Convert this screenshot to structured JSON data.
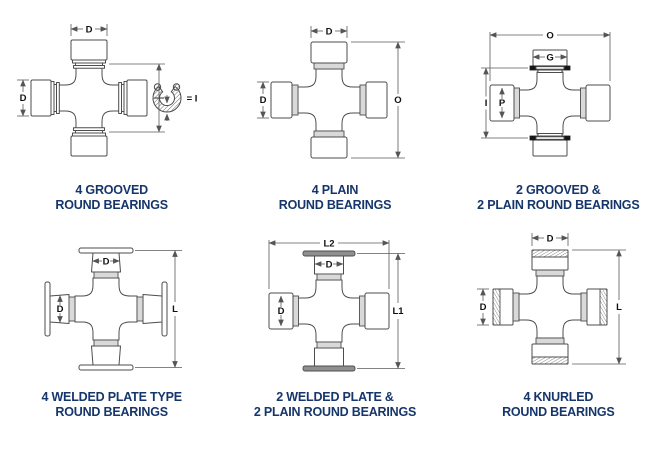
{
  "page": {
    "background": "#ffffff",
    "caption_color": "#16366b",
    "line_color": "#4d4d4d"
  },
  "diagrams": [
    {
      "name": "4-grooved-round-bearings",
      "caption": [
        "4 GROOVED",
        "ROUND BEARINGS"
      ],
      "labels": {
        "top": "D",
        "left": "D",
        "ring": "= I"
      },
      "icon": "snap-ring"
    },
    {
      "name": "4-plain-round-bearings",
      "caption": [
        "4 PLAIN",
        "ROUND BEARINGS"
      ],
      "labels": {
        "top": "D",
        "left": "D",
        "right": "O"
      }
    },
    {
      "name": "2-grooved-2-plain-round-bearings",
      "caption": [
        "2 GROOVED &",
        "2 PLAIN ROUND BEARINGS"
      ],
      "labels": {
        "top": "O",
        "cap": "G",
        "left": "I",
        "bore": "P"
      }
    },
    {
      "name": "4-welded-plate-type-round-bearings",
      "caption": [
        "4 WELDED PLATE TYPE",
        "ROUND BEARINGS"
      ],
      "labels": {
        "top": "D",
        "left": "D",
        "right": "L"
      }
    },
    {
      "name": "2-welded-plate-2-plain-round-bearings",
      "caption": [
        "2 WELDED PLATE &",
        "2 PLAIN ROUND BEARINGS"
      ],
      "labels": {
        "top": "L2",
        "cap": "D",
        "left": "D",
        "right": "L1"
      }
    },
    {
      "name": "4-knurled-round-bearings",
      "caption": [
        "4 KNURLED",
        "ROUND BEARINGS"
      ],
      "labels": {
        "top": "D",
        "left": "D",
        "right": "L"
      }
    }
  ]
}
